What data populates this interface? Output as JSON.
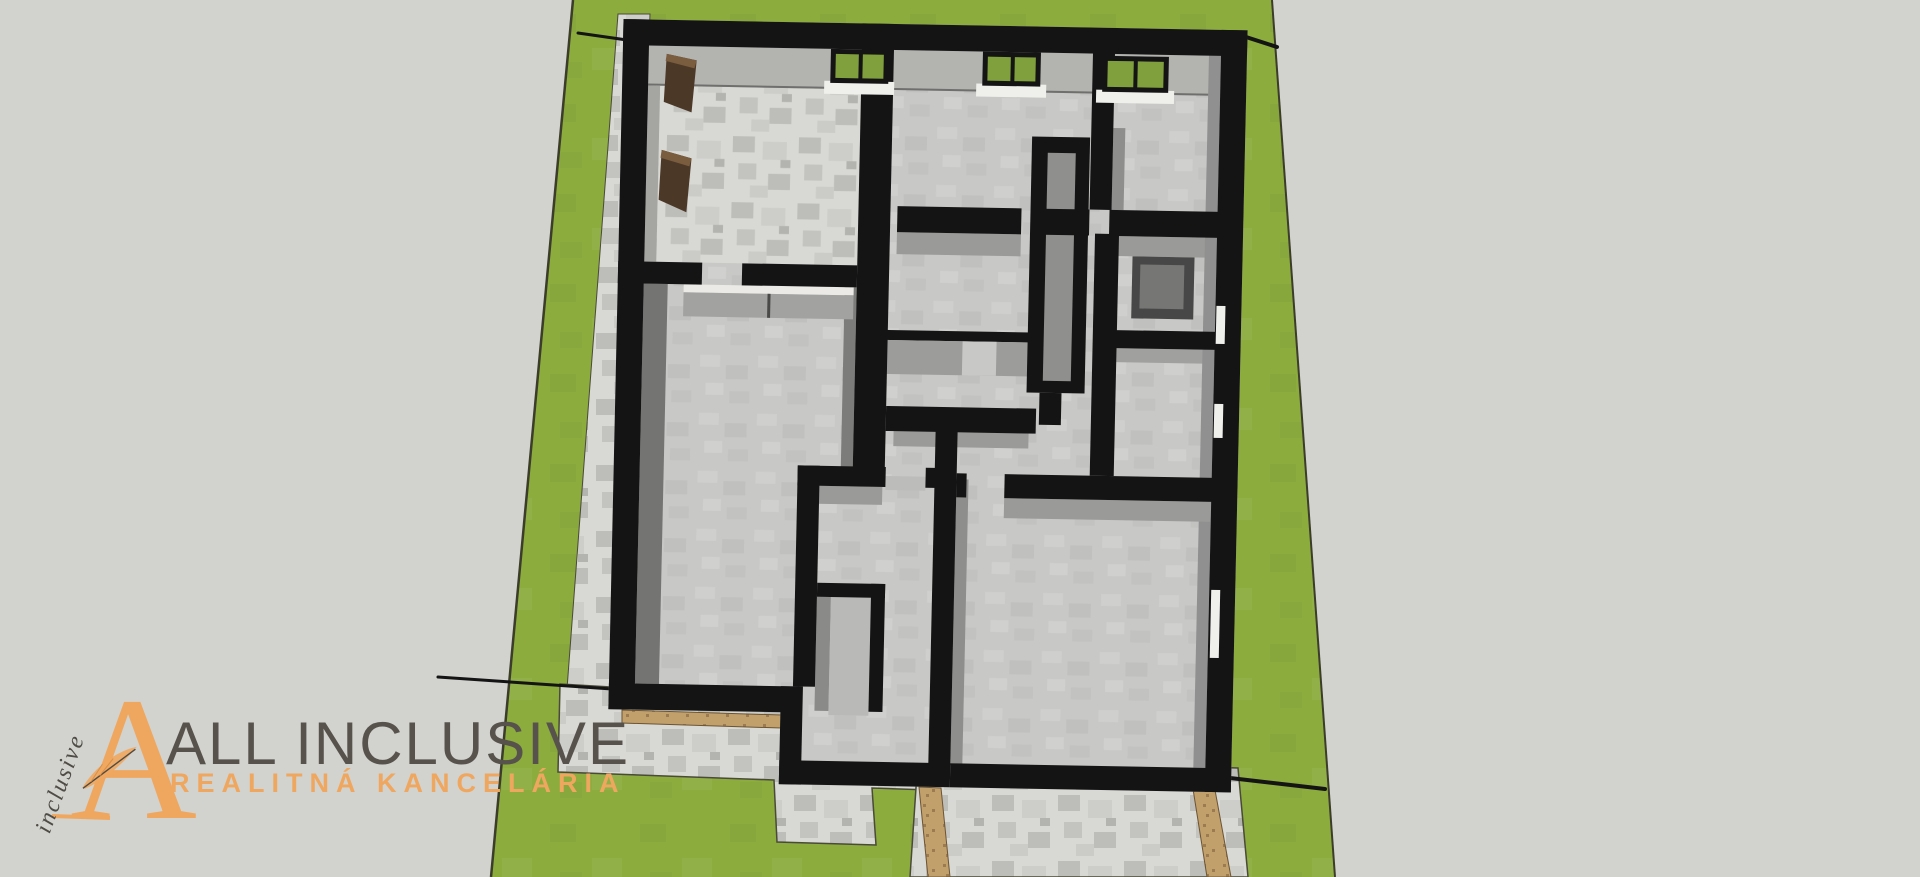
{
  "watermark": {
    "monogram": "A",
    "script": "inclusive",
    "title": "ALL INCLUSIVE",
    "subtitle": "REALITNÁ KANCELÁRIA"
  },
  "scene": {
    "type": "3d-floor-plan-top-view",
    "description": "Aerial SketchUp-style render of a single-storey house floor plan with black wall tops, grey room floors, windows with white sills, a paved walkway and terrace, gravel driveway strips, all placed on a green parcel over a light grey background.",
    "elements": [
      "green-parcel",
      "parcel-boundary-left",
      "parcel-boundary-right",
      "house-floor-plan",
      "walkway-paving",
      "terrace-paving",
      "driveway-paving",
      "threshold-strip",
      "gravel-strip-left",
      "gravel-strip-right",
      "fence-line-top-left",
      "fence-line-top-right",
      "fence-line-bottom-left",
      "fence-line-bottom-right",
      "window-1",
      "window-2",
      "window-3",
      "window-slits",
      "wardrobe",
      "kitchen-partition",
      "shower-block",
      "chimney-core",
      "closet",
      "shelf-slats"
    ]
  },
  "colors": {
    "background": "#d2d3ce",
    "grass": "#8cac3e",
    "lot_edge": "#3c3c2a",
    "wall": "#141414",
    "floor": "#c8c8c6",
    "wall_face": "#9a9a98",
    "wall_face_dark": "#747472",
    "pavement": "#d8d8d4",
    "pavement_patch": "#bdbdb9",
    "tan": "#c2a06c",
    "tan_dark": "#8c6b44",
    "wood": "#4c3827",
    "wood_light": "#7a5c3e",
    "window_sill": "#efefec",
    "glass_green": "#7fa03c",
    "logo_orange": "#efa75f",
    "logo_grey": "#57534c",
    "logo_script": "#4f4c45"
  }
}
